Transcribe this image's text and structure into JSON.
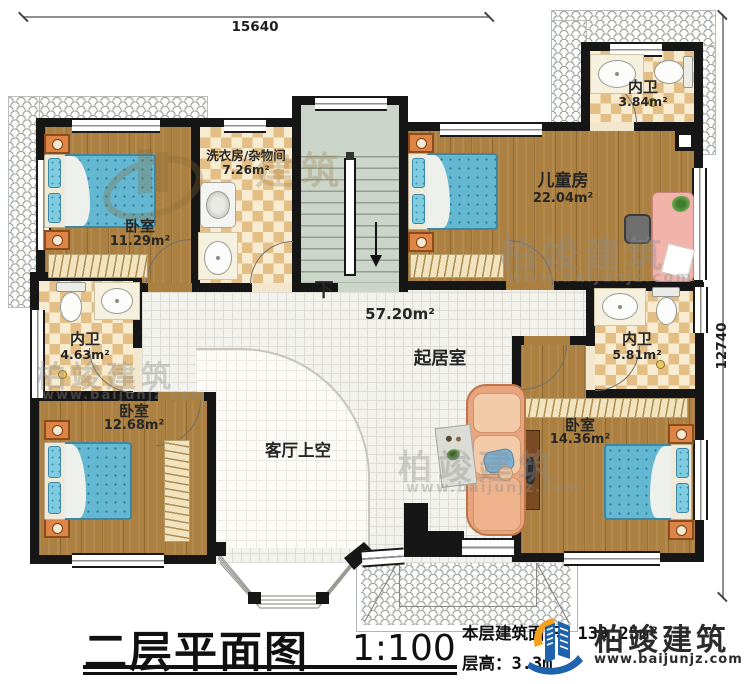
{
  "dimensions": {
    "top": "15640",
    "right": "12740"
  },
  "rooms": {
    "bedroom_tl": {
      "name": "卧室",
      "area": "11.29m²"
    },
    "laundry": {
      "name": "洗衣房/杂物间",
      "area": "7.26m²"
    },
    "kids": {
      "name": "儿童房",
      "area": "22.04m²"
    },
    "bath_tr": {
      "name": "内卫",
      "area": "3.84m²"
    },
    "bath_left": {
      "name": "内卫",
      "area": "4.63m²"
    },
    "bath_right": {
      "name": "内卫",
      "area": "5.81m²"
    },
    "bedroom_bl": {
      "name": "卧室",
      "area": "12.68m²"
    },
    "bedroom_br": {
      "name": "卧室",
      "area": "14.36m²"
    },
    "living": {
      "name": "起居室",
      "area": "57.20m²"
    },
    "void": {
      "name": "客厅上空"
    },
    "stairs": {
      "down_label": "下"
    }
  },
  "title_block": {
    "title": "二层平面图",
    "scale": "1:100",
    "area_label": "本层建筑面积：",
    "area_value": "139.25m²",
    "floor_height_label": "层高：",
    "floor_height_value": "3.3m"
  },
  "logo": {
    "name": "柏竣建筑",
    "url": "www.baijunjz.com"
  },
  "watermark": {
    "name": "柏竣建筑",
    "url": "www.baijunjz.com",
    "short": "建筑"
  },
  "colors": {
    "wall": "#161616",
    "wood": "#ab8040",
    "check_dark": "#e4bf85",
    "mattress": "#64b7d1",
    "stair": "#cbd5c9",
    "sofa": "#e8a47e",
    "logo_blue": "#1f63ad",
    "logo_orange": "#f5a01e"
  }
}
